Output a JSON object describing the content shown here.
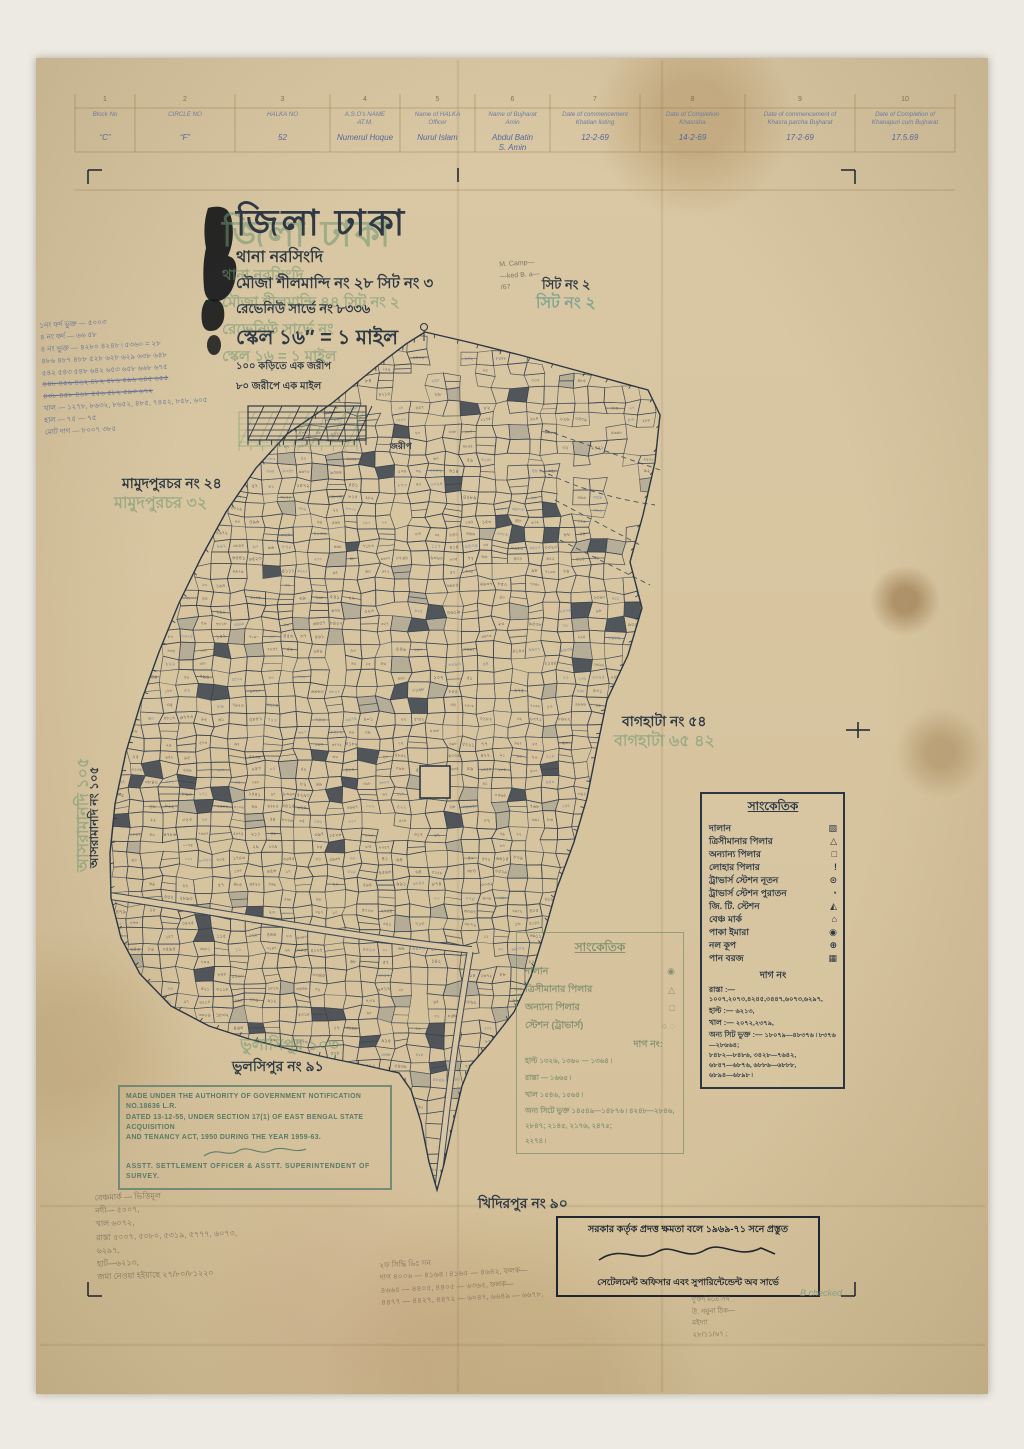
{
  "header_table": {
    "col_numbers": [
      "1",
      "2",
      "3",
      "4",
      "5",
      "6",
      "7",
      "8",
      "9",
      "10"
    ],
    "columns": [
      {
        "header": "Block No",
        "value": "“C”"
      },
      {
        "header": "CIRCLE NO",
        "value": "“F”"
      },
      {
        "header": "HALKA NO",
        "value": "52"
      },
      {
        "header": "A.S.O's NAME\nAT.M.",
        "value": "Numerul Hoque"
      },
      {
        "header": "Name of HALKA\nOfficer",
        "value": "Nurul Islam"
      },
      {
        "header": "Name of Bujharat\nAmin",
        "value": "Abdul Batin\nS. Amin"
      },
      {
        "header": "Date of commencement\nKhatian listing",
        "value": "12-2-69"
      },
      {
        "header": "Date of Completion\nKhasraha",
        "value": "14-2-69"
      },
      {
        "header": "Date of commencement of\nKhasra parcha Bujharat",
        "value": "17-2-69"
      },
      {
        "header": "Date of Completion of\nKhanapuri cum Bujharat",
        "value": "17.5.69"
      }
    ]
  },
  "title_block": {
    "district": "জিলা ঢাকা",
    "thana": "থানা নরসিংদি",
    "mouza": "মৌজা শীলমান্দি নং ২৮ সিট নং ৩",
    "revenue": "রেভেনিউ সার্ভে নং ৮৩৩৬",
    "scale": "স্কেল ১৬″ = ১ মাইল",
    "scale_note1": "১০০ কড়িতে এক জরীপ",
    "scale_note2": "৮০ জরীপে এক মাইল",
    "scalebar_label": "জরীপ",
    "ghost_district": "জিলা ঢাকা",
    "ghost_lines": [
      "থানা নরসিংদি",
      "মৌজা শীলমান্দি ৪৪ সিট নং ২",
      "রেভেনিউ সার্ভে নং",
      "স্কেল ১৬ = ১ মাইল"
    ]
  },
  "map_labels": {
    "sheet": "সিট নং ২",
    "sheet_ghost": "সিট নং ২",
    "mamudpur": "মামুদপুরচর নং ২৪",
    "mamudpur_ghost": "মামুদপুরচর ৩২",
    "baghata": "বাগহাটা নং ৫৪",
    "baghata_ghost": "বাগহাটা ৬৫ ৪২",
    "tulshipur": "ভুলসিপুর নং ৯১",
    "tulshipur_ghost": "ভুলাসিপুর ১০৩",
    "khidirpur": "খিদিরপুর নং ৯০",
    "left_vertical": "আসরামানদি নং ১০৫",
    "left_vertical_ghost": "আসরামানদি ১০৫"
  },
  "legend": {
    "title": "সাংকেতিক",
    "items": [
      {
        "label": "দালান",
        "glyph": "▨",
        "symbol": "hatched-building"
      },
      {
        "label": "ত্রিসীমানার পিলার",
        "glyph": "△",
        "symbol": "tri-junction-pillar"
      },
      {
        "label": "অন্যান্য পিলার",
        "glyph": "□",
        "symbol": "other-pillar"
      },
      {
        "label": "লোহার পিলার",
        "glyph": "!",
        "symbol": "iron-pillar"
      },
      {
        "label": "ট্রাভার্স স্টেশন নূতন",
        "glyph": "⊙",
        "symbol": "traverse-station-new"
      },
      {
        "label": "ট্রাভার্স স্টেশন পুরাতন",
        "glyph": "◔",
        "symbol": "traverse-station-old"
      },
      {
        "label": "জি. টি. স্টেশন",
        "glyph": "◭",
        "symbol": "gt-station"
      },
      {
        "label": "বেঞ্চ মার্ক",
        "glyph": "⌂",
        "symbol": "bench-mark"
      },
      {
        "label": "পাকা ইমারা",
        "glyph": "◉",
        "symbol": "pucca-building"
      },
      {
        "label": "নল কূপ",
        "glyph": "⊕",
        "symbol": "tube-well"
      },
      {
        "label": "পান বরজ",
        "glyph": "▦",
        "symbol": "betel-garden"
      }
    ],
    "dag_title": "দাগ নং",
    "dag_lines": [
      {
        "label": "রাস্তা :—",
        "value": "১০০৭,২০৭৩,৪২৪৫,৩৪৪৭,৬০৭৩,৬২৯৭,"
      },
      {
        "label": "হাল্ট :—",
        "value": "৬২১৩,"
      },
      {
        "label": "খাল :—",
        "value": "২০৭২,২৩৭৯,"
      },
      {
        "label": "অন্য সিট ভুক্ত :—",
        "value": "১৮০৭৯—৪৮৩৭৬ ৷ ৮৩৭৬—২৮৬৬৪;\n৮৪৮২—৮৪৮৬, ৩৪২৮—৭৬৪২,\n৬৮৪৭—৬৮৭৬, ৬৮৮৬—৬৮৮৮,\n৬৮৯৪—৬৮৯৮ ৷"
      }
    ]
  },
  "legend_faint": {
    "title": "সাংকেতিক",
    "items": [
      {
        "label": "দালান",
        "glyph": "◉"
      },
      {
        "label": "ত্রিসীমানার পিলার",
        "glyph": "△"
      },
      {
        "label": "অন্যান্য পিলার",
        "glyph": "□"
      },
      {
        "label": "স্টেশন (ট্রাভার্স)",
        "glyph": "○ ◌"
      }
    ],
    "dag_title": "দাগ নং:",
    "dag_lines": [
      {
        "label": "হাল্ট",
        "value": "১৩২৬, ১৩৬০ — ১৩৬৪ ৷"
      },
      {
        "label": "রাস্তা",
        "value": "— ১৬৬৫ ৷"
      },
      {
        "label": "খাল",
        "value": "১৫৪৬, ১৫৬৪ ৷"
      },
      {
        "label": "অন্য সিটে ভুক্ত",
        "value": "১৪৫৪৯—১৪৮৭৬ ৷ ৪২৪৮—২৮৪৬,\n২৮৪৭; ২১৪৫, ২১৭৬, ২৪৭৫;\n২২৭৪ ৷"
      }
    ]
  },
  "stamp_en": {
    "line1": "MADE UNDER THE AUTHORITY OF GOVERNMENT NOTIFICATION NO.18636 L.R.",
    "line2": "DATED 13-12-55, UNDER SECTION 17(1) OF EAST BENGAL STATE ACQUISITION",
    "line3": "AND TENANCY ACT, 1950 DURING THE YEAR 1959-63.",
    "footer": "ASSTT. SETTLEMENT OFFICER & ASSTT. SUPERINTENDENT OF SURVEY."
  },
  "stamp_bn": {
    "line1": "সরকার কর্তৃক প্রদত্ত ক্ষমতা বলে ১৯৬৯-৭১ সনে প্রস্তুত",
    "line2": "সেটেলমেন্ট অফিসার এবং সুপারিন্টেন্ডেন্ট অব সার্ভে"
  },
  "annotations": {
    "top_left_blue": "১নং ফর্দ ভুক্ত — ৫০০৩\n৪ নং ফর্দ — ৬৬ ৫৮\n৪ নং ভুক্ত — ৪২৮০ ৪২৪৮ ৷ ৫৩৬০ = ২৮\n৪৮৬ ৪৮৭ ৪৮৮ ৫২৮ ৬২৮ ৬২৯ ৬৩৮ ৬৪৮\n৫৪২ ৫৪৩ ৫৪৮ ৬৪২ ৬৫৩ ৬৫৮ ৬৬৮ ৬৭৫\n৪৪৮ ৪৫৬ ৪৬২ ৪৮২ ৫৮৬ ৫৯৬ ৬৪৫ ৬৫৫\n৪৩৮ ৪৫৮ ৪৬৮ ৫৫৬ ৫৮২ ৫৯৩ ৬৭২\nখাল — ১২৭৮, ৮৬৩২, ৮৬৫২, ৪৮৫, ৭৪৫২, ৮৫৮, ৬০৫\nহাল — ৭৫            — ৭৫\nমোট দাগ — ৮০০৭ ৩৮৫",
    "sheet_pencil": "M. Camp—\n—ked B. a—\n/67",
    "bottom_left_pencil": "বেঞ্চমার্ক — ভিত্তিমূল\nনদী— ৫০০৭,\nখাল ৬০৭২,\nরাস্তা ৫০০৭, ৫০৮০, ৫৩১৯, ৫৭৭৭, ৬০৭৩,\n৬২৯৭,\nহাট—৬২১৩,\nজমা নেওয়া হইয়াছে   ২৭/৮০/৮১২২০",
    "bottom_center_pencil": "২ফ সিদ্ধি ৬িঃ সন\nদাগ ৪০০৬ — ৪১৬৪ ৷ ৪১৬৫ — ৪৬৪২, ফলক—\n৪৬৬৫ — ৪৪০৫, ৪৪০৫ — ৬৩৬৫, ফলক—\n৪৪৭৭ — ৪৪২৭, ৪৪৭২ — ৬০৪৭, ৬৬৪৯ — ৬৬৭৮,",
    "bottom_right_pencil": "দু'ফর্দ মতে সব\nউ. নমুনা ঠিক—\nমইদ্যা\n২৮/১১/৬৭ ;",
    "checked_note": "B checked"
  }
}
